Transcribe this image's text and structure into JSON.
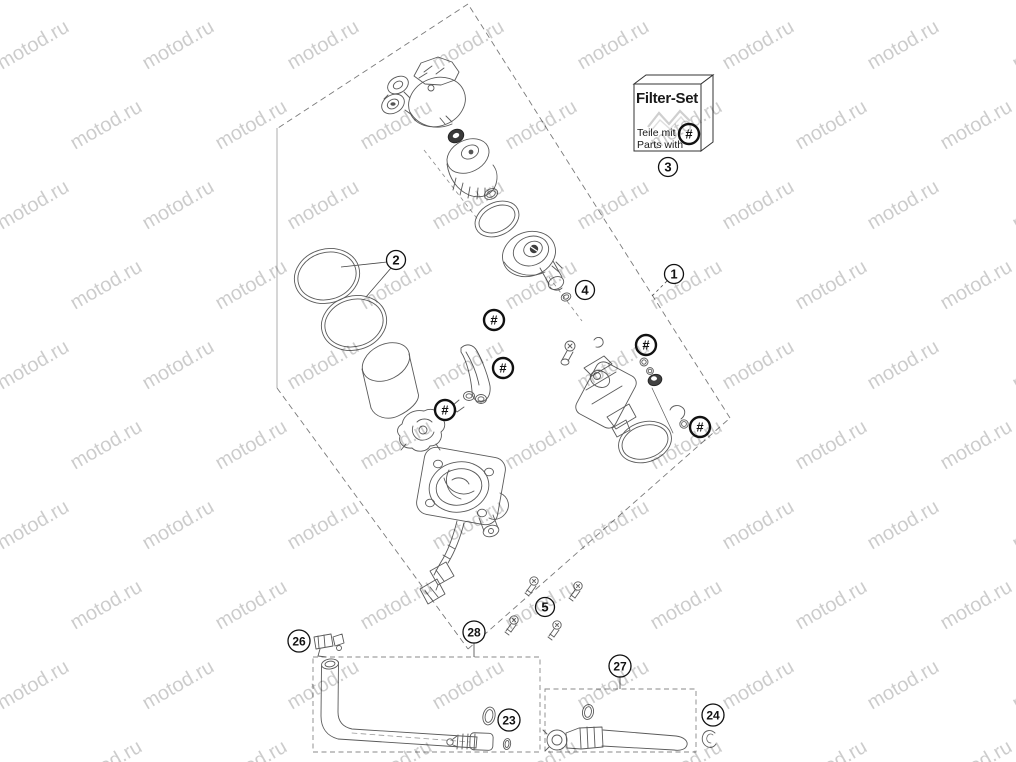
{
  "page": {
    "width": 1016,
    "height": 762,
    "background": "#ffffff"
  },
  "watermark": {
    "text": "motod.ru",
    "color": "rgba(0,0,0,0.20)",
    "font_size": 20,
    "angle": -30
  },
  "filter_set": {
    "title": "Filter-Set",
    "line1": "Teile mit",
    "line2": "Parts with"
  },
  "colors": {
    "ink": "#5a5a5a",
    "callout_ink": "#111111",
    "dark_part": "#414141"
  },
  "callouts": [
    {
      "label": "1",
      "x": 674,
      "y": 274,
      "type": "number"
    },
    {
      "label": "2",
      "x": 396,
      "y": 260,
      "type": "number"
    },
    {
      "label": "3",
      "x": 668,
      "y": 167,
      "type": "number"
    },
    {
      "label": "4",
      "x": 585,
      "y": 290,
      "type": "number"
    },
    {
      "label": "5",
      "x": 545,
      "y": 607,
      "type": "number"
    },
    {
      "label": "23",
      "x": 509,
      "y": 720,
      "type": "number"
    },
    {
      "label": "24",
      "x": 713,
      "y": 715,
      "type": "number"
    },
    {
      "label": "26",
      "x": 299,
      "y": 641,
      "type": "number"
    },
    {
      "label": "27",
      "x": 620,
      "y": 666,
      "type": "number"
    },
    {
      "label": "28",
      "x": 474,
      "y": 632,
      "type": "number"
    },
    {
      "label": "#",
      "x": 689,
      "y": 134,
      "type": "hash"
    },
    {
      "label": "#",
      "x": 494,
      "y": 320,
      "type": "hash"
    },
    {
      "label": "#",
      "x": 503,
      "y": 368,
      "type": "hash"
    },
    {
      "label": "#",
      "x": 445,
      "y": 410,
      "type": "hash"
    },
    {
      "label": "#",
      "x": 646,
      "y": 345,
      "type": "hash"
    },
    {
      "label": "#",
      "x": 700,
      "y": 427,
      "type": "hash"
    }
  ]
}
